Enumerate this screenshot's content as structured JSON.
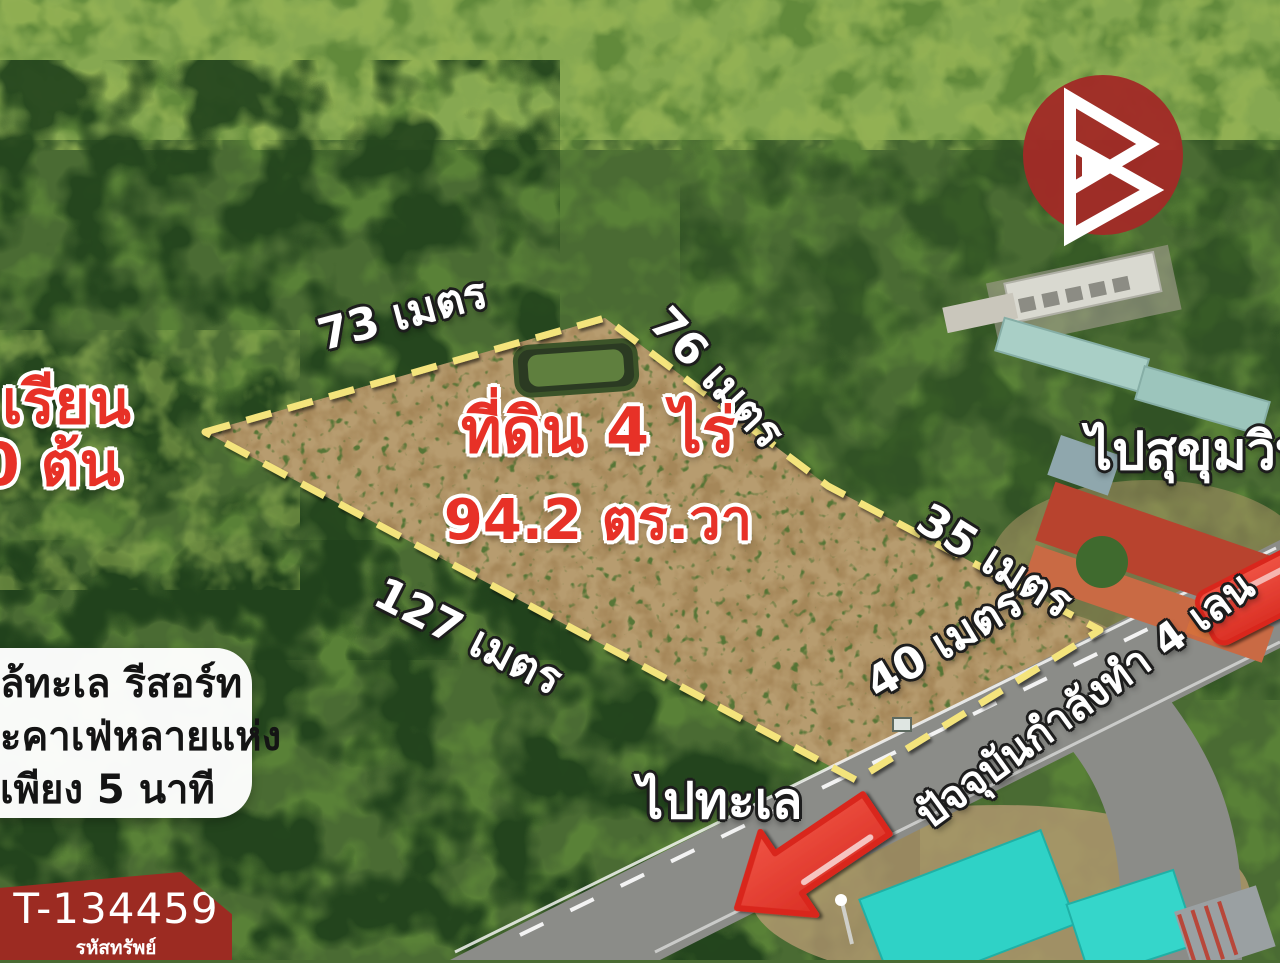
{
  "overlay": {
    "title_line1": "ที่ดิน 4 ไร่",
    "title_line2": "94.2 ตร.วา",
    "measurements": [
      {
        "label": "73 เมตร"
      },
      {
        "label": "76 เมตร"
      },
      {
        "label": "35 เมตร"
      },
      {
        "label": "40 เมตร"
      },
      {
        "label": "127 เมตร"
      }
    ],
    "left_red_line1": "เรียน",
    "left_red_line2": "0 ต้น",
    "info_lines": {
      "line1": "ล้ทะเล รีสอร์ท",
      "line2": "ะคาเฟ่หลายแห่ง",
      "line3": "เพียง 5 นาที"
    },
    "dir_sukhumvit": "ไปสุขุมวิท",
    "dir_sea": "ไปทะเล",
    "road_note": "ปัจจุบันกำลังทำ 4 เลน",
    "badge": {
      "code": "T-134459",
      "caption": "รหัสทรัพย์"
    },
    "colors": {
      "boundary_yellow": "#f4e47c",
      "text_red": "#e73127",
      "arrow_red": "#e53a2e",
      "badge_red": "#9c2b22",
      "logo_red": "#a12b26",
      "roof_turquoise": "#2fd2c6",
      "roof_red": "#b8432e"
    }
  }
}
